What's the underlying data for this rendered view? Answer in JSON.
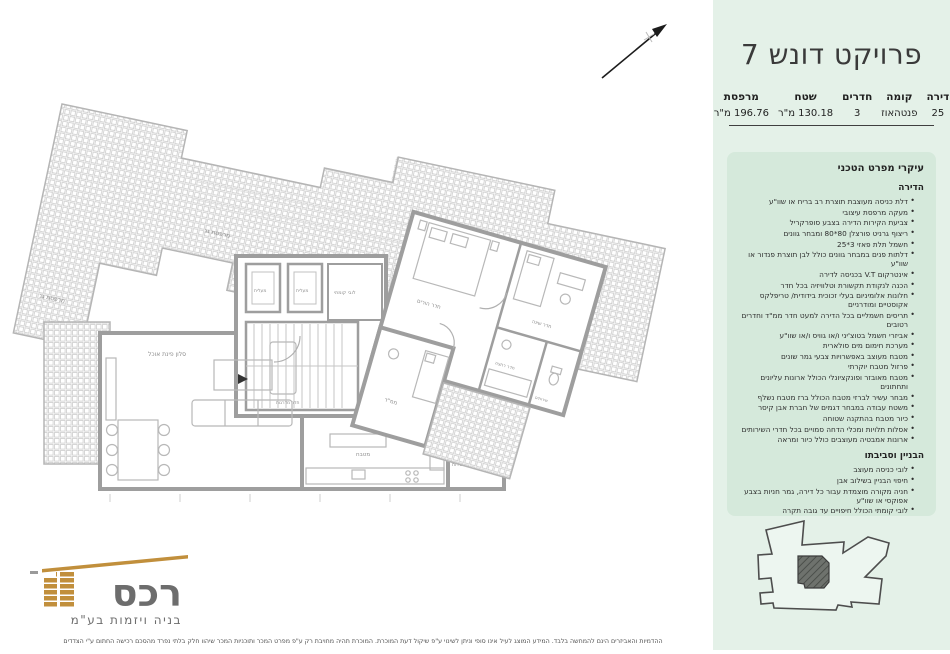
{
  "header": {
    "title": "פרויקט דונש 7"
  },
  "table": {
    "columns": [
      {
        "header": "דירה",
        "value": "25"
      },
      {
        "header": "קומה",
        "value": "פנטהאוז"
      },
      {
        "header": "חדרים",
        "value": "3"
      },
      {
        "header": "שטח",
        "value": "130.18 מ\"ר"
      },
      {
        "header": "מרפסת",
        "value": "196.76 מ\"ר"
      }
    ]
  },
  "specs": {
    "title": "עיקרי מפרט הטכני",
    "sections": [
      {
        "heading": "הדירה",
        "items": [
          "דלת כניסה מעוצבת תוצרת רב בריח או שוו\"ע",
          "מעקה מרפסת עיצובי",
          "צביעת הקירות הדירה בצבע סופרקריל",
          "ריצוף גרניט פורצלן 80*80 ומבחר גוונים",
          "חשמל תלת פאזי 3*25",
          "דלתות פנים במבחר גוונים כולל לבן תוצרת פנדור או שוו\"ע",
          "אינטרקום V.T בכניסה לדירה",
          "הכנה לנקודת תקשורת וטלוויזיה בכל חדר",
          "חלונות אלומיניום בעלי זכוכית בידודית/ טריפלקס אקוסטיים ומודרניים",
          "תריסים חשמליים בכל הדירה למעט חדר ממ\"ד וחדרים רטובים",
          "אביזרי חשמל בטוצ'יני ו/או גוויס ו/או שוו\"ע",
          "מערכת חימום מים סולארית",
          "מטבח מעוצב באפשרויות צבעי גמר שונים",
          "פרזול מטבח יוקרתי",
          "מטבח מאובזר ופונקציונלי הכולל ארונות עליונים ותחתונים",
          "מבחר עשיר לברזי מטבח הכולל ברז מטבח נשלף",
          "משטח עבודה במבחר דגמים של חברת אבן קיסר",
          "כיור מטבח בהתקנה שטוחה",
          "אסלות תלויות ומכלי הדחה סמויים בכל חדרי השירותים",
          "ארונות אמבטיה מעוצבים כולל כיור ומראה"
        ]
      },
      {
        "heading": "הבניין וסביבתו",
        "items": [
          "לובי כניסה מעוצב",
          "חיפוי הבניין בשילוב אבן",
          "חניה מקורה מוצמדת עבור כל דירה, גמר חניות בצבע אפוקסי או שוו\"ע",
          "לובי קומתי הכולל חיפויים עד גובה תקרה"
        ]
      }
    ]
  },
  "plan": {
    "labels": {
      "roof_terrace": "מרפסת גג",
      "living": "סלון פינת אוכל",
      "kitchen": "מטבח",
      "elevator": "מעלית",
      "stairs": "חדר מדרגות",
      "lobby": "לובי קומתי",
      "master": "חדר הורים",
      "bedroom": "חדר שינה",
      "mamad": "ממ\"ד",
      "bath": "חדר רחצה",
      "wc": "שירותים",
      "service": "מרפסת שירות"
    }
  },
  "logo": {
    "name": "רכס",
    "tagline": "בניה ויזמות בע\"מ"
  },
  "disclaimer": "ההדמיות והאביזרים הינם להמחשה בלבד. המידע המוצג לעיל אינו סופי וניתן לשינוי ע\"פ שיקול דעת המוכרת. המוכרת תהיה מחויבת רק ע\"פ מפרט המכר ותוכניות המכר שיהוו חלק בלתי נפרד מהסכם רכישה החתום ע\"י הצדדים",
  "colors": {
    "sidebar_bg": "#e4f1e8",
    "panel_bg": "#d5e9db",
    "ink": "#3a3a3a",
    "gold": "#c18f3c",
    "wall_gray": "#9e9e9e"
  }
}
